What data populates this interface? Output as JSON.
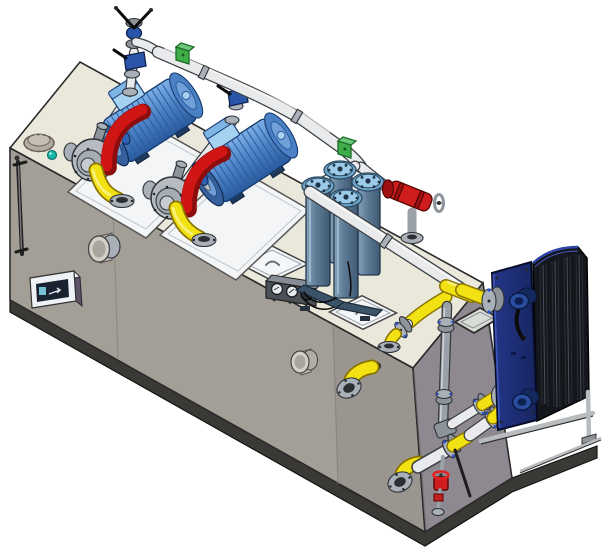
{
  "canvas": {
    "width": 605,
    "height": 547
  },
  "scene": {
    "type": "cad-render",
    "description": "Isometric CAD rendering of a lube oil circulation skid: beige reservoir tank with two blue motor / gear-pump sets with red coupling guards and yellow suction elbows, white discharge header with green pipe clamps and blue shutoff valves, duplex filter with red changeover valve, gray riser piping, yellow flanged customer connections and a navy plate heat exchanger mounted on an extended base frame.",
    "background": "#ffffff",
    "visible_text": []
  },
  "palette": {
    "bg": "#ffffff",
    "outline": "#2b2b2b",
    "tank_top": "#eae7db",
    "tank_front": "#a39e96",
    "tank_end": "#8e8890",
    "tank_base": "#3b3936",
    "seam": "#8b867e",
    "plate_white": "#f3f5f7",
    "hatch": "#f4f6f8",
    "motor_blue": "#4a80c4",
    "motor_blue_light": "#7db0e8",
    "motor_blue_dark": "#2a5a9e",
    "motor_box": "#a6d2f2",
    "coupling_blue": "#2d62b5",
    "guard_red": "#d01515",
    "guard_red_dark": "#8c0d0d",
    "pump_gray": "#b6bcc2",
    "pipe_white": "#e8eaec",
    "pipe_shade": "#b7bcc1",
    "pipe_outline": "#3b3f44",
    "gray_pipe": "#9aa1a8",
    "steel": "#a9b0b7",
    "steel_dark": "#2e3338",
    "yellow": "#f2e113",
    "yellow_dark": "#8a7400",
    "green_clamp": "#3fae4a",
    "green_clamp_dark": "#1d6b28",
    "valve_blue": "#2a55a8",
    "filter_body": "#5c7a94",
    "filter_body_dark": "#3f5a73",
    "filter_cap": "#9ccae9",
    "red_valve": "#cf1d1d",
    "teal": "#17b9a8",
    "hx_navy": "#24368a",
    "hx_navy_dark": "#17255f",
    "hx_pack": "#14171c",
    "hx_frame": "#b9bcbf",
    "gauge_panel": "#4b5157",
    "cable": "#0a0a0a",
    "accent_gasket": "#2b51cc",
    "display_side": "#5d5468",
    "screen": "#1a2230"
  },
  "components": {
    "reservoir-tank": "Oil reservoir tank",
    "tank-top-face": "Tank top surface",
    "tank-front-face": "Tank front wall",
    "tank-end-face": "Tank end wall",
    "skid-base": "Skid base frame",
    "level-gauge": "Tank level gauge",
    "level-indicator-display": "Level indicator display box",
    "vent-cap": "Filler breather cap",
    "breather-cap": "Breather dome",
    "inspection-port-1": "Front inspection port",
    "inspection-port-2": "Front inspection port",
    "access-hatch-1": "Access hatch cover",
    "access-hatch-2": "Access hatch cover",
    "access-hatch-3": "Access hatch cover",
    "gauge-panel": "Pressure gauge panel",
    "pump-set-1": "Motor-pump set 1",
    "pump-set-2": "Motor-pump set 2",
    "electric-motor": "Electric motor",
    "gear-pump": "Gear pump",
    "coupling-guard": "Coupling guard",
    "suction-elbow": "Suction elbow",
    "discharge-riser": "Pump discharge riser",
    "check-valve": "Check valve",
    "shutoff-valve": "Butterfly shutoff valve",
    "header-pipe": "Discharge header pipe",
    "pipe-clamp-1": "Pipe clamp",
    "pipe-clamp-2": "Pipe clamp",
    "duplex-filter": "Duplex filter",
    "filter-changeover-valve": "Filter changeover valve",
    "filter-outlet-pipe": "Filter outlet pipe",
    "return-tee": "Return line tee",
    "tank-return-flange": "Tank return flange",
    "cooler-riser-pipe": "Cooler riser pipe",
    "plate-heat-exchanger": "Plate heat exchanger",
    "hx-plate-pack": "Heat exchanger plate pack",
    "hx-frame-plate": "Heat exchanger frame plate",
    "hx-nozzle": "Heat exchanger nozzle",
    "hx-support-frame": "Heat exchanger support frame",
    "customer-connection-1": "Flanged customer connection",
    "customer-connection-2": "Flanged customer connection",
    "drain-valve": "Drain valve",
    "pipe-support": "Pipe support strut"
  }
}
